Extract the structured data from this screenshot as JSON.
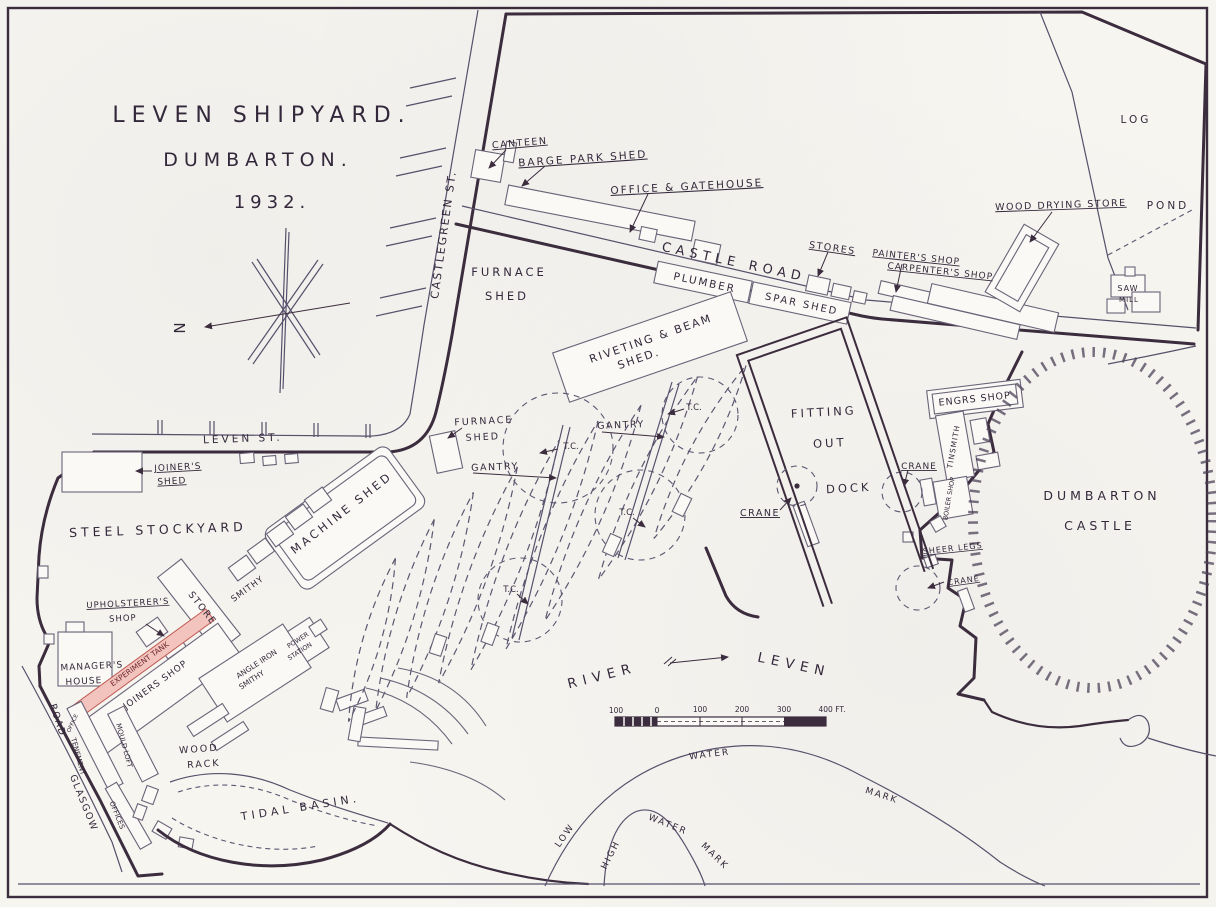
{
  "map_title": {
    "line1": "LEVEN SHIPYARD.",
    "line2": "DUMBARTON.",
    "line3": "1932."
  },
  "compass": {
    "north": "N"
  },
  "colors": {
    "ink": "#3b2c3e",
    "paper": "#f7f5f0",
    "building_outline": "#6a6378",
    "experiment_tank_fill": "#f3c3bd",
    "experiment_tank_edge": "#c05a54"
  },
  "labels": {
    "castlegreen_st": "CASTLEGREEN ST.",
    "leven_st": "LEVEN ST.",
    "castle_road": "CASTLE ROAD",
    "glasgow": "GLASGOW",
    "road": "ROAD",
    "canteen": "CANTEEN",
    "barge_park_shed": "BARGE PARK SHED",
    "office_gatehouse": "OFFICE & GATEHOUSE",
    "plumber": "PLUMBER",
    "spar_shed": "SPAR SHED",
    "stores": "STORES",
    "painters_shop": "PAINTER'S SHOP",
    "carpenters_shop": "CARPENTER'S SHOP",
    "wood_drying_store": "WOOD DRYING STORE",
    "log": "LOG",
    "pond": "POND",
    "saw": "SAW",
    "mill": "MILL",
    "furnace": "FURNACE",
    "shed": "SHED",
    "riveting_beam": "RIVETING & BEAM",
    "shed_dot": "SHED.",
    "joiners_shed": "JOINER'S",
    "steel_stockyard": "STEEL STOCKYARD",
    "machine_shed": "MACHINE SHED",
    "gantry": "GANTRY",
    "tc": "T.C.",
    "fitting": "FITTING",
    "out": "OUT",
    "dock": "DOCK",
    "crane": "CRANE",
    "engrs_shop": "ENGRS SHOP",
    "tinsmith": "TINSMITH",
    "boiler_shop": "BOILER SHOP",
    "sheer_legs": "SHEER LEGS",
    "dumbarton": "DUMBARTON",
    "castle": "CASTLE",
    "upholsterers": "UPHOLSTERER'S",
    "shop": "SHOP",
    "store": "STORE",
    "smithy": "SMITHY",
    "managers": "MANAGER'S",
    "house": "HOUSE",
    "experiment_tank": "EXPERIMENT TANK",
    "joiners_shop": "JOINERS SHOP",
    "angle_iron": "ANGLE IRON",
    "power": "POWER",
    "station": "STATION",
    "wood": "WOOD",
    "rack": "RACK",
    "office": "OFFICE",
    "tenement": "TENEMENT",
    "mould_loft": "MOULD LOFT",
    "offices": "OFFICES",
    "tidal_basin": "TIDAL BASIN.",
    "river": "RIVER",
    "leven": "LEVEN",
    "low": "LOW",
    "water": "WATER",
    "mark": "MARK",
    "high": "HIGH"
  },
  "scale_bar": {
    "ticks": [
      "100",
      "0",
      "100",
      "200",
      "300"
    ],
    "end_label": "400 FT."
  }
}
